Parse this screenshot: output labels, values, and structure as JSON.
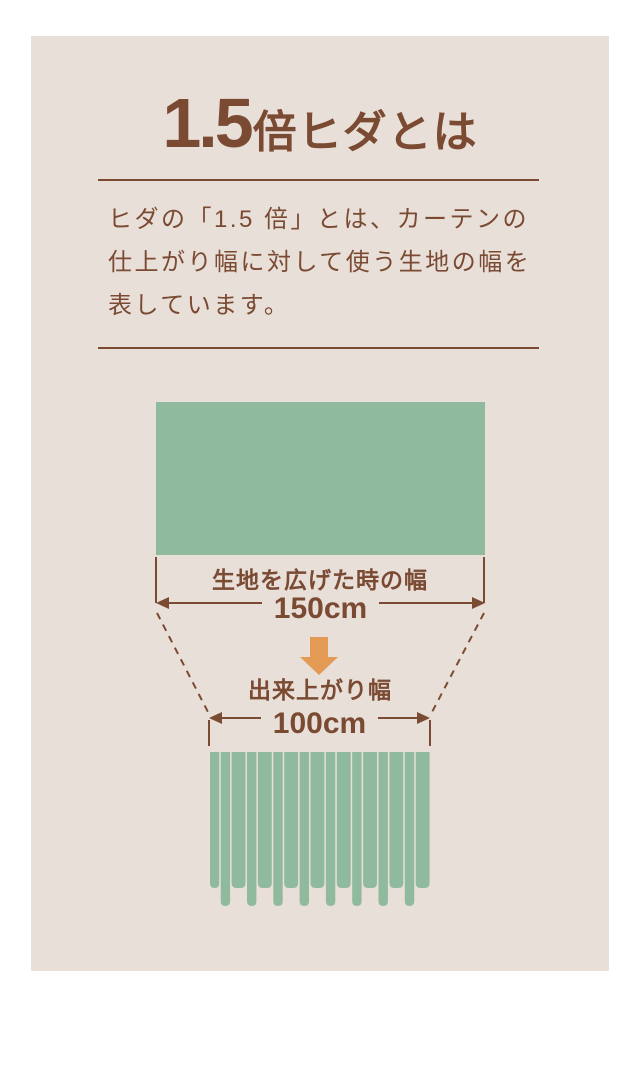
{
  "colors": {
    "page": "#FFFFFF",
    "card": "#E9DFD9",
    "green": "#90BA9E",
    "brown": "#7A4A32",
    "orange": "#E29A54"
  },
  "title": {
    "number": "1.5",
    "suffix": "倍ヒダとは"
  },
  "description": {
    "lines": [
      "ヒダの「1.5 倍」とは、カーテンの",
      "仕上がり幅に対して使う生地の幅を",
      "表しています。"
    ]
  },
  "diagram": {
    "fabric_width": {
      "label": "生地を広げた時の幅",
      "value": "150cm"
    },
    "finished_width": {
      "label": "出来上がり幅",
      "value": "100cm"
    }
  }
}
